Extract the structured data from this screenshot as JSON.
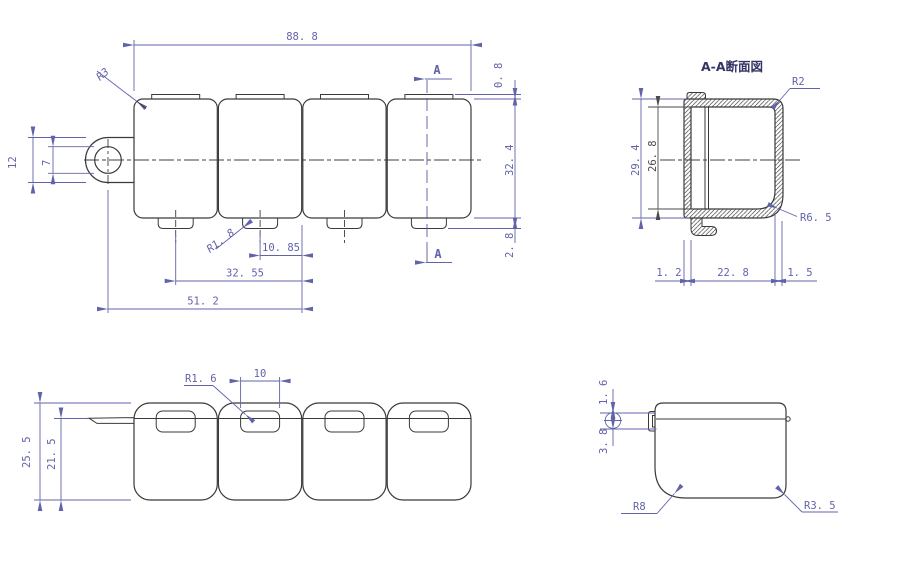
{
  "colors": {
    "geometry_line": "#3a3a3a",
    "dimension_blue": "#6163aa",
    "dimension_dark": "#4a4a4a",
    "title_text": "#343465",
    "background": "#ffffff"
  },
  "labels": {
    "front": {
      "overall_width": "88. 8",
      "overall_height": "32. 4",
      "top_tab_height": "0. 8",
      "bottom_tab_height": "2. 8",
      "radius_corner": "R3",
      "radius_bottom_tab": "R1. 8",
      "dim_10_85": "10. 85",
      "dim_32_55": "32. 55",
      "dim_51_2": "51. 2",
      "tab_height": "12",
      "hole_diameter": "7",
      "section_letter_top": "A",
      "section_letter_bottom": "A"
    },
    "section": {
      "title": "A-A断面図",
      "outer_height": "29. 4",
      "inner_height": "26. 8",
      "radius_top": "R2",
      "radius_bottom": "R6. 5",
      "wall_left": "1. 2",
      "inner_width": "22. 8",
      "wall_right": "1. 5"
    },
    "plan": {
      "overall_depth": "25. 5",
      "body_depth": "21. 5",
      "slot_width": "10",
      "slot_radius": "R1. 6"
    },
    "side": {
      "dim_1_6": "1. 6",
      "dim_3_8": "3. 8",
      "radius_left": "R8",
      "radius_right": "R3. 5"
    }
  }
}
